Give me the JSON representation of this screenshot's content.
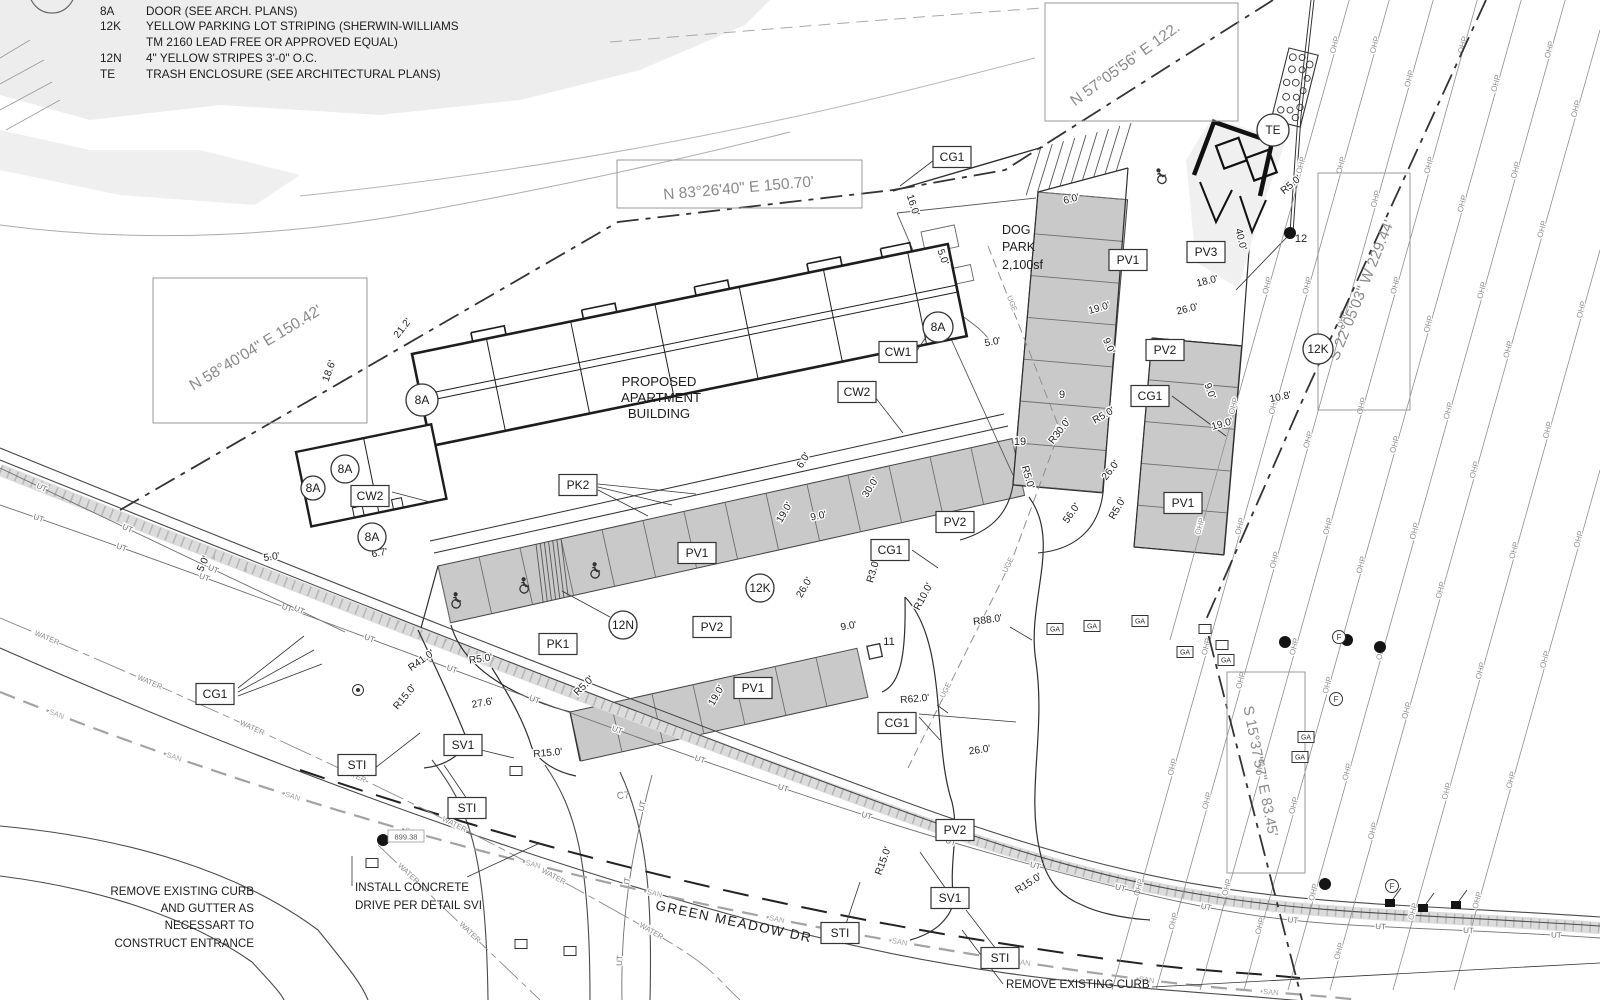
{
  "notes": {
    "heading": "NOTES:",
    "items": [
      {
        "key": "8A",
        "text": "DOOR (SEE ARCH. PLANS)"
      },
      {
        "key": "12K",
        "text": "YELLOW PARKING LOT STRIPING (SHERWIN-WILLIAMS",
        "text2": "TM 2160 LEAD FREE OR APPROVED EQUAL)"
      },
      {
        "key": "12N",
        "text": "4\" YELLOW STRIPES 3'-0\" O.C."
      },
      {
        "key": "TE",
        "text": "TRASH ENCLOSURE (SEE ARCHITECTURAL PLANS)"
      }
    ]
  },
  "survey": {
    "bearings": [
      {
        "text": "N 83°26'40\" E  150.70'"
      },
      {
        "text": "N 58°40'04\" E  150.42'"
      },
      {
        "text": "N 57°05'56\" E  122."
      },
      {
        "text": "S 22°05'03\" W  229.44'"
      },
      {
        "text": "S 15°37'57\" E  83.45'"
      }
    ]
  },
  "texts": {
    "building": [
      "PROPOSED",
      "APARTMENT",
      "BUILDING"
    ],
    "dog_park": [
      "DOG",
      "PARK",
      "2,100sf"
    ],
    "street": "GREEN MEADOW DR",
    "remove_curb_gutter": [
      "REMOVE EXISTING CURB",
      "AND GUTTER AS",
      "NECESSART TO",
      "CONSTRUCT ENTRANCE"
    ],
    "install_drive": [
      "INSTALL CONCRETE",
      "DRIVE PER DETAIL SVI"
    ],
    "remove_curb": "REMOVE EXISTING CURB",
    "curve_ref": "C7",
    "spot_elevation": "899.38"
  },
  "labels": {
    "boxed": [
      [
        "CG1",
        952,
        157
      ],
      [
        "CW1",
        898,
        352
      ],
      [
        "CW2",
        857,
        392
      ],
      [
        "CW2",
        370,
        496
      ],
      [
        "PK2",
        578,
        485
      ],
      [
        "PV1",
        1128,
        260
      ],
      [
        "PV3",
        1206,
        252
      ],
      [
        "PV2",
        1165,
        350
      ],
      [
        "CG1",
        1150,
        396
      ],
      [
        "PV1",
        1183,
        503
      ],
      [
        "PV2",
        955,
        522
      ],
      [
        "CG1",
        890,
        550
      ],
      [
        "PV1",
        697,
        553
      ],
      [
        "PV2",
        712,
        627
      ],
      [
        "PK1",
        558,
        644
      ],
      [
        "PV1",
        753,
        688
      ],
      [
        "CG1",
        215,
        694
      ],
      [
        "CG1",
        897,
        723
      ],
      [
        "SV1",
        463,
        745
      ],
      [
        "STI",
        357,
        765
      ],
      [
        "STI",
        467,
        808
      ],
      [
        "PV2",
        955,
        830
      ],
      [
        "SV1",
        950,
        898
      ],
      [
        "STI",
        840,
        933
      ],
      [
        "STI",
        1000,
        958
      ]
    ],
    "circled": [
      [
        "TE",
        1273,
        130,
        16
      ],
      [
        "8A",
        938,
        327,
        15
      ],
      [
        "8A",
        422,
        400,
        16
      ],
      [
        "8A",
        345,
        469,
        14
      ],
      [
        "8A",
        313,
        488,
        12
      ],
      [
        "8A",
        372,
        537,
        14
      ],
      [
        "12K",
        1318,
        349,
        15
      ],
      [
        "12K",
        760,
        588,
        14
      ],
      [
        "12N",
        623,
        625,
        14
      ]
    ],
    "counts": [
      [
        "9",
        1062,
        398
      ],
      [
        "19",
        1020,
        445
      ],
      [
        "11",
        889,
        645
      ],
      [
        "12",
        1301,
        242
      ]
    ]
  },
  "dims": [
    [
      "16.0'",
      910,
      206,
      72
    ],
    [
      "5.0'",
      940,
      258,
      70
    ],
    [
      "6.0'",
      1072,
      202,
      -14
    ],
    [
      "19.0'",
      1100,
      311,
      -16
    ],
    [
      "9.0'",
      1106,
      347,
      66
    ],
    [
      "26.0'",
      1188,
      312,
      -14
    ],
    [
      "18.0'",
      1208,
      284,
      -14
    ],
    [
      "40.0'",
      1238,
      240,
      76
    ],
    [
      "R5.0'",
      1293,
      187,
      -40
    ],
    [
      "5.0'",
      993,
      345,
      -10
    ],
    [
      "9.0'",
      1207,
      392,
      70
    ],
    [
      "19.0'",
      1223,
      427,
      -16
    ],
    [
      "10.8'",
      1281,
      400,
      -12
    ],
    [
      "R30.0'",
      1062,
      433,
      -52
    ],
    [
      "R5.0'",
      1105,
      418,
      -30
    ],
    [
      "26.0'",
      1113,
      472,
      -52
    ],
    [
      "56.0'",
      1074,
      515,
      -55
    ],
    [
      "R5.0'",
      1025,
      478,
      74
    ],
    [
      "R5.0'",
      1120,
      510,
      -60
    ],
    [
      "19.0'",
      787,
      514,
      -60
    ],
    [
      "9.0'",
      819,
      519,
      -12
    ],
    [
      "26.0'",
      807,
      589,
      -60
    ],
    [
      "9.0'",
      849,
      629,
      -10
    ],
    [
      "19.0'",
      719,
      697,
      -60
    ],
    [
      "R5.0'",
      586,
      688,
      -45
    ],
    [
      "R41.0'",
      423,
      663,
      -35
    ],
    [
      "R5.0'",
      481,
      662,
      -8
    ],
    [
      "R15.0'",
      407,
      699,
      -50
    ],
    [
      "27.6'",
      483,
      706,
      -10
    ],
    [
      "R15.0'",
      548,
      756,
      -5
    ],
    [
      "R3.0'",
      876,
      572,
      -74
    ],
    [
      "R10.0'",
      926,
      598,
      -62
    ],
    [
      "R88.0'",
      988,
      623,
      -8
    ],
    [
      "R62.0'",
      915,
      702,
      -5
    ],
    [
      "26.0'",
      980,
      753,
      -8
    ],
    [
      "R15.0'",
      886,
      862,
      -70
    ],
    [
      "R15.0'",
      1030,
      886,
      -33
    ],
    [
      "21.2'",
      405,
      330,
      -52
    ],
    [
      "18.6'",
      332,
      372,
      -70
    ],
    [
      "6.7'",
      380,
      556,
      -10
    ],
    [
      "5.0'",
      206,
      565,
      -66
    ],
    [
      "5.0'",
      272,
      560,
      -8
    ],
    [
      "6.0'",
      806,
      462,
      -58
    ],
    [
      "30.0'",
      873,
      489,
      -58
    ]
  ],
  "parking": {
    "bands": [
      {
        "p": [
          438,
          566
        ],
        "u": [
          41.0,
          -9.1
        ],
        "v": [
          12.6,
          56.8
        ],
        "n": 14
      },
      {
        "p": [
          570,
          712
        ],
        "u": [
          41.0,
          -9.1
        ],
        "v": [
          10.9,
          49.0
        ],
        "n": 7
      },
      {
        "p": [
          1038,
          192
        ],
        "u": [
          -3.6,
          41.8
        ],
        "v": [
          89.6,
          7.7
        ],
        "n": 7
      },
      {
        "p": [
          1152,
          338
        ],
        "u": [
          -3.6,
          41.8
        ],
        "v": [
          89.6,
          7.7
        ],
        "n": 5
      }
    ],
    "hatches": [
      {
        "p": [
          536,
          544
        ],
        "a": [
          25,
          -5.5
        ],
        "b": [
          12.6,
          56.8
        ],
        "n": 6
      },
      {
        "p": [
          1041,
          147
        ],
        "a": [
          90,
          -24
        ],
        "b": [
          5,
          43
        ],
        "n": 8
      }
    ],
    "handicap": [
      [
        455,
        601,
        -12
      ],
      [
        523,
        586,
        -12
      ],
      [
        594,
        571,
        -12
      ],
      [
        1160,
        177,
        -30
      ]
    ]
  },
  "utilities": {
    "lines": [
      {
        "label": "OHP",
        "path": "M1352,-10 L1170,640",
        "every": 125,
        "size": 8,
        "color": "#8f8f8f",
        "w": 0.8,
        "start": 55
      },
      {
        "label": "OHP",
        "path": "M1392,-10 L1112,990",
        "every": 125,
        "size": 8,
        "color": "#8f8f8f",
        "w": 0.8,
        "start": 55
      },
      {
        "label": "OHP",
        "path": "M1436,-10 L1156,990",
        "every": 125,
        "size": 8,
        "color": "#8f8f8f",
        "w": 0.8,
        "start": 90
      },
      {
        "label": "OHP",
        "path": "M1480,-10 L1200,990",
        "every": 125,
        "size": 8,
        "color": "#8f8f8f",
        "w": 0.8,
        "start": 55
      },
      {
        "label": "OHP",
        "path": "M1524,-10 L1244,990",
        "every": 125,
        "size": 8,
        "color": "#8f8f8f",
        "w": 0.8,
        "start": 95
      },
      {
        "label": "OHP",
        "path": "M1568,-10 L1288,990",
        "every": 125,
        "size": 8,
        "color": "#8f8f8f",
        "w": 0.8,
        "start": 60
      },
      {
        "label": "OHP",
        "path": "M1600,30 L1330,990",
        "every": 125,
        "size": 8,
        "color": "#8f8f8f",
        "w": 0.8,
        "start": 80
      },
      {
        "label": "OHP",
        "path": "M1600,250 L1393,990",
        "every": 125,
        "size": 8,
        "color": "#8f8f8f",
        "w": 0.8,
        "start": 60
      },
      {
        "label": "OHP",
        "path": "M1600,470 L1454,990",
        "every": 125,
        "size": 8,
        "color": "#8f8f8f",
        "w": 0.8,
        "start": 70
      },
      {
        "label": "UT",
        "path": "M0,505 C350,625 700,772 1000,856 S1300,918 1600,938",
        "every": 88,
        "size": 8,
        "color": "#6f6f6f",
        "w": 0.9,
        "start": 40
      },
      {
        "label": "UT",
        "path": "M0,468 L345,632",
        "every": 95,
        "size": 8,
        "color": "#6f6f6f",
        "w": 0.9,
        "start": 45
      },
      {
        "label": "UT",
        "path": "M652,775 C632,850 620,920 622,1000",
        "every": 78,
        "size": 8,
        "color": "#6f6f6f",
        "w": 0.9,
        "start": 30
      },
      {
        "label": "WATER",
        "path": "M0,618 C200,702 400,792 560,880 S700,962 740,1000",
        "every": 112,
        "size": 7.5,
        "color": "#8a8a8a",
        "w": 0.9,
        "dash": "34 5 7 5",
        "start": 50
      },
      {
        "label": "WATER",
        "path": "M378,845 L540,1000",
        "every": 85,
        "size": 7.5,
        "color": "#8a8a8a",
        "w": 0.9,
        "dash": "26 5 6 5",
        "start": 40
      },
      {
        "label": "SAN",
        "path": "M0,692 C300,812 600,890 900,942 S1250,988 1360,1000",
        "every": 125,
        "size": 7.5,
        "color": "#a3a3a3",
        "w": 2.2,
        "dash": "16 9",
        "start": 60
      },
      {
        "label": "UGE",
        "path": "M988,246 L1060,430 L1012,560 L908,768",
        "every": 140,
        "size": 7.5,
        "color": "#8f8f8f",
        "w": 1,
        "dash": "9 5",
        "start": 60
      }
    ],
    "symbols": {
      "poles": [
        [
          1285,
          642
        ],
        [
          1347,
          640
        ],
        [
          1380,
          647
        ],
        [
          1325,
          884
        ],
        [
          383,
          840
        ],
        [
          1290,
          233
        ]
      ],
      "flag_boxes": [
        [
          1390,
          903
        ],
        [
          1423,
          908
        ],
        [
          1456,
          905
        ]
      ],
      "boxes": [
        [
          1205,
          629
        ],
        [
          516,
          771
        ],
        [
          372,
          863
        ],
        [
          521,
          944
        ],
        [
          570,
          951
        ],
        [
          1222,
          645
        ]
      ],
      "ga_boxes": [
        [
          1055,
          629
        ],
        [
          1092,
          626
        ],
        [
          1140,
          621
        ],
        [
          1226,
          660
        ],
        [
          1306,
          737
        ],
        [
          1300,
          757
        ],
        [
          1185,
          652
        ]
      ],
      "f_circles": [
        [
          1339,
          637
        ],
        [
          1336,
          699
        ],
        [
          1392,
          886
        ]
      ],
      "double_circles": [
        [
          358,
          690
        ]
      ],
      "ga_label": "GA",
      "f_label": "F"
    }
  },
  "leaders": [
    [
      934,
      160,
      900,
      186
    ],
    [
      916,
      352,
      936,
      322
    ],
    [
      875,
      397,
      903,
      433
    ],
    [
      392,
      492,
      430,
      502
    ],
    [
      598,
      490,
      648,
      516
    ],
    [
      598,
      487,
      672,
      505
    ],
    [
      598,
      484,
      696,
      494
    ],
    [
      610,
      617,
      562,
      591
    ],
    [
      238,
      688,
      304,
      636
    ],
    [
      238,
      692,
      314,
      650
    ],
    [
      238,
      696,
      322,
      664
    ],
    [
      912,
      550,
      938,
      568
    ],
    [
      1172,
      396,
      1226,
      436
    ],
    [
      919,
      717,
      940,
      740
    ],
    [
      919,
      714,
      1016,
      722
    ],
    [
      481,
      750,
      514,
      758
    ],
    [
      375,
      768,
      420,
      733
    ],
    [
      467,
      799,
      444,
      765
    ],
    [
      946,
      889,
      920,
      852
    ],
    [
      846,
      924,
      860,
      882
    ],
    [
      996,
      949,
      966,
      910
    ],
    [
      467,
      877,
      540,
      843
    ],
    [
      352,
      886,
      352,
      856
    ],
    [
      1003,
      984,
      962,
      930
    ],
    [
      1152,
      987,
      1600,
      963
    ],
    [
      1010,
      627,
      1032,
      640
    ],
    [
      937,
      705,
      948,
      713
    ]
  ],
  "colors": {
    "site_line": "#2e2e2e",
    "existing_line": "#8a8a8a",
    "survey_text": "#8a8a8a",
    "parking_fill": "#c9c9c9",
    "dim_text": "#1f1f1f"
  }
}
